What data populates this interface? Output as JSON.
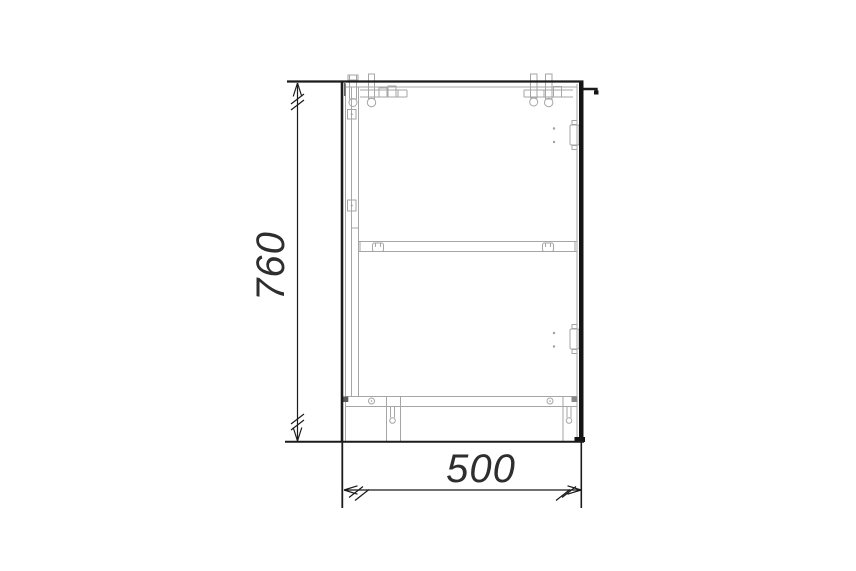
{
  "page": {
    "background_color": "#ffffff"
  },
  "drawing": {
    "kind": "furniture-technical-drawing",
    "subject": "base-cabinet-section",
    "structure_line_color": "#1b1b1b",
    "detail_line_color": "#a6a6a6",
    "dimensions": {
      "height_mm": "760",
      "width_mm": "500"
    },
    "parts": [
      "top-extension-line",
      "cam-bolt-fittings",
      "side-panel",
      "back-strip",
      "middle-shelf",
      "shelf-supports",
      "hinge-plates",
      "door-panel",
      "door-handle",
      "bottom-panel",
      "adjustable-legs",
      "floor-line"
    ]
  }
}
